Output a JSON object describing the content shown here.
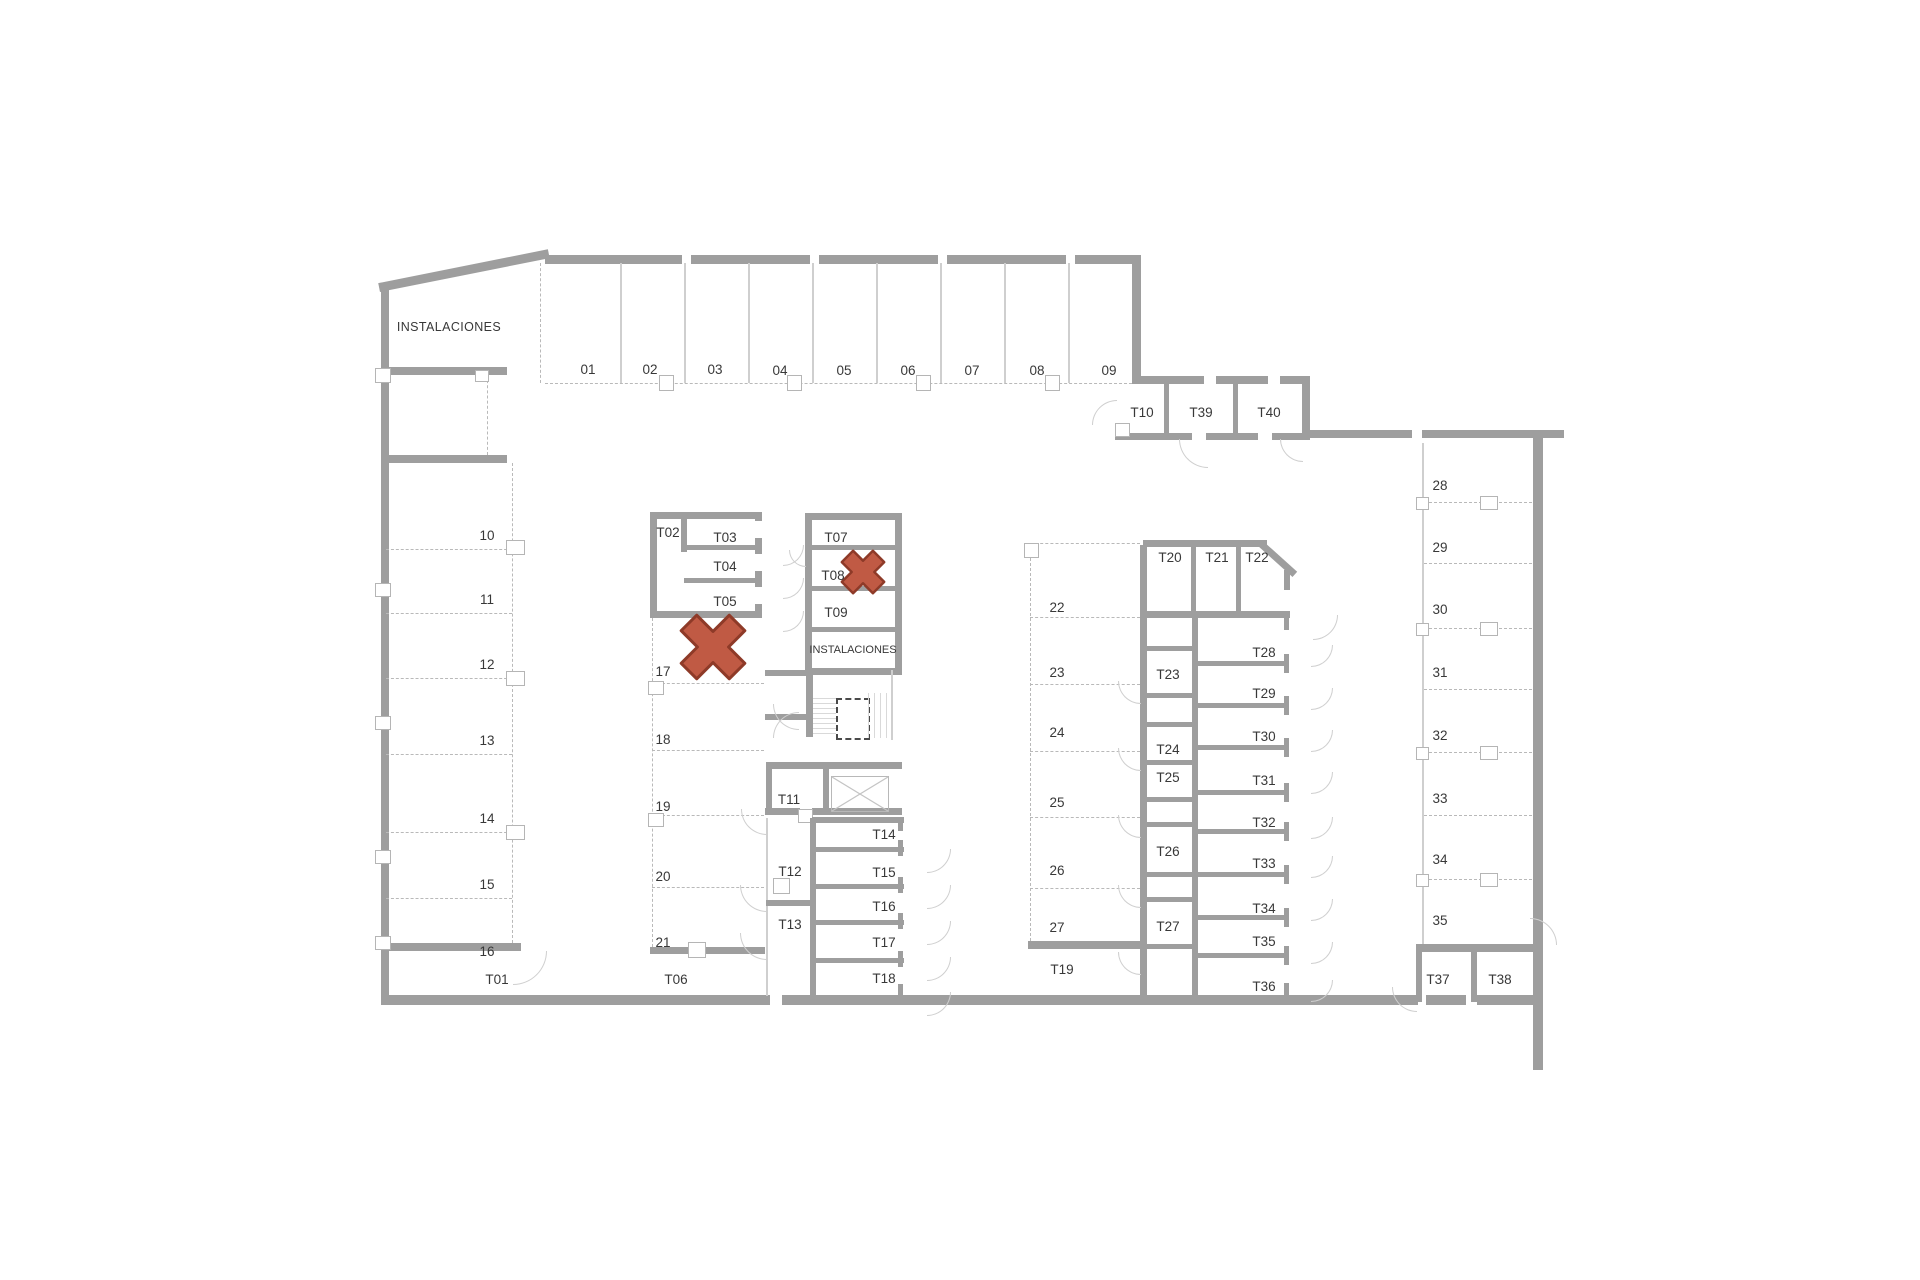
{
  "colors": {
    "wall": "#9e9e9e",
    "cross_fill": "#c05a44",
    "cross_stroke": "#8e3a28"
  },
  "labels": {
    "instalaciones_top": "INSTALACIONES",
    "instalaciones_mid": "INSTALACIONES"
  },
  "rooms": {
    "top": [
      "01",
      "02",
      "03",
      "04",
      "05",
      "06",
      "07",
      "08",
      "09"
    ],
    "upper_right": [
      "T10",
      "T39",
      "T40"
    ],
    "left": [
      "10",
      "11",
      "12",
      "13",
      "14",
      "15",
      "16"
    ],
    "left_end": "T01",
    "block_a_storage": [
      "T02",
      "T03",
      "T04",
      "T05"
    ],
    "block_a_rooms": [
      "17",
      "18",
      "19",
      "20",
      "21"
    ],
    "block_a_end": "T06",
    "block_b_storage": [
      "T07",
      "T08",
      "T09"
    ],
    "block_b_lower": [
      "T11",
      "T12",
      "T13"
    ],
    "block_b_right": [
      "T14",
      "T15",
      "T16",
      "T17",
      "T18"
    ],
    "center": [
      "22",
      "23",
      "24",
      "25",
      "26",
      "27"
    ],
    "center_end": "T19",
    "east_top": [
      "T20",
      "T21",
      "T22"
    ],
    "east_mid": [
      "T23",
      "T24",
      "T25",
      "T26",
      "T27"
    ],
    "east_col": [
      "T28",
      "T29",
      "T30",
      "T31",
      "T32",
      "T33",
      "T34",
      "T35",
      "T36"
    ],
    "far_right": [
      "28",
      "29",
      "30",
      "31",
      "32",
      "33",
      "34",
      "35"
    ],
    "far_right_end": [
      "T37",
      "T38"
    ]
  }
}
